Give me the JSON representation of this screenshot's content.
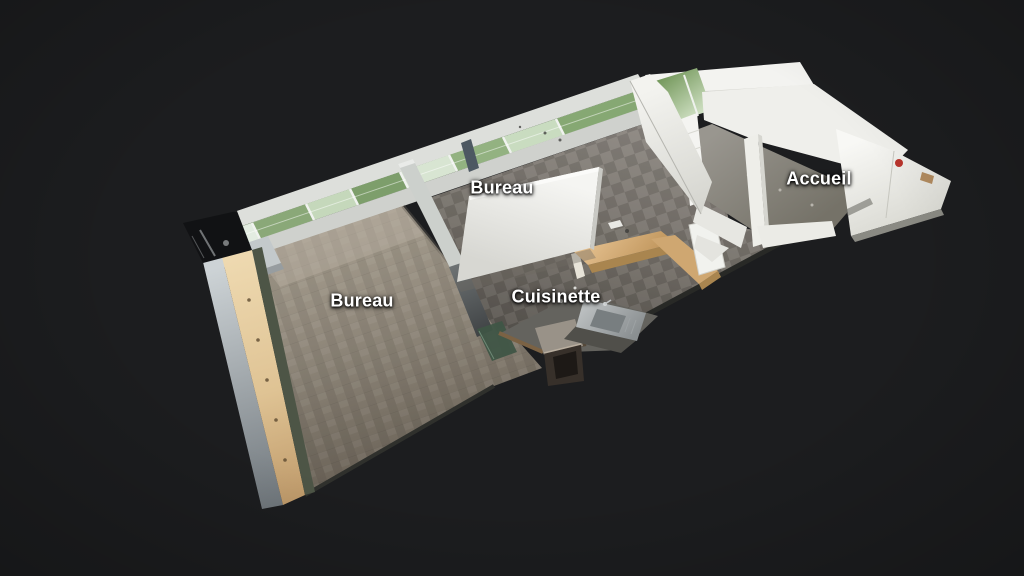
{
  "viewer": {
    "type": "3d-dollhouse-tour",
    "background_color": "#1c1d1f",
    "label_color": "#ffffff"
  },
  "labels": [
    {
      "id": "bureau-window",
      "text": "Bureau"
    },
    {
      "id": "bureau-main",
      "text": "Bureau"
    },
    {
      "id": "cuisinette",
      "text": "Cuisinette"
    },
    {
      "id": "accueil",
      "text": "Accueil"
    }
  ]
}
